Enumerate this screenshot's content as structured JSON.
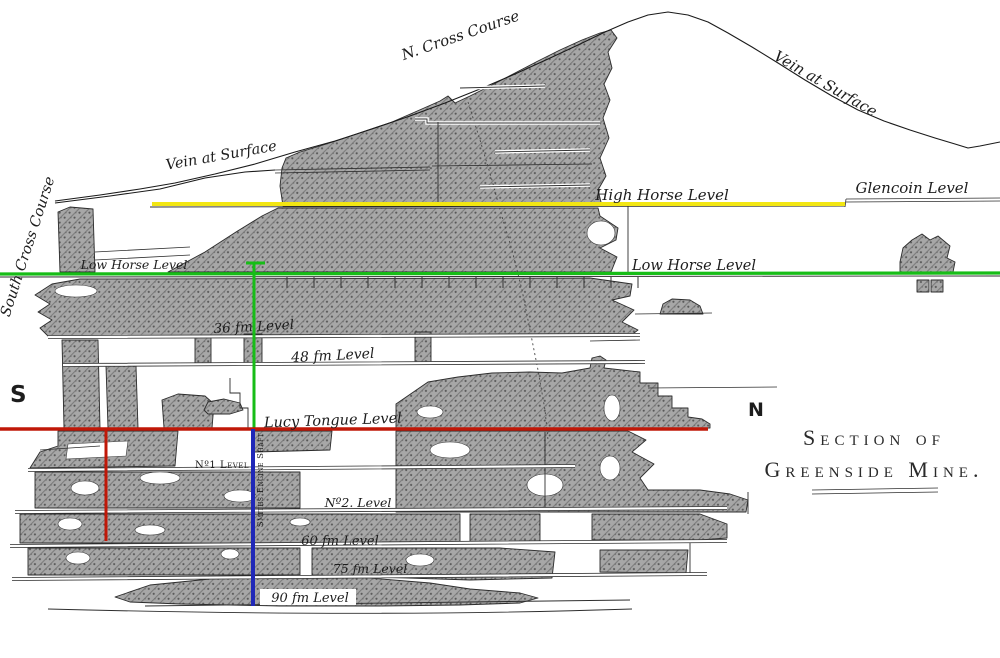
{
  "title": {
    "line1": "Section of",
    "line2": "Greenside Mine."
  },
  "compass": {
    "south": "S",
    "north": "N"
  },
  "surface_labels": {
    "south_cross_course": "South Cross Course",
    "north_cross_course": "N. Cross Course",
    "vein_at_surface_left": "Vein at Surface",
    "vein_at_surface_right": "Vein at Surface"
  },
  "levels": {
    "high_horse": "High Horse Level",
    "glencoin": "Glencoin Level",
    "low_horse_south": "Low Horse Level",
    "low_horse_north": "Low Horse Level",
    "fm36": "36 fm Level",
    "fm48": "48 fm Level",
    "lucy_tongue": "Lucy Tongue Level",
    "no1": "Nº1 Level",
    "no2": "Nº2. Level",
    "fm60": "60 fm Level",
    "fm75": "75 fm Level",
    "fm90": "90 fm Level"
  },
  "shaft": {
    "smiths_engine": "Smiths Engine Shaft"
  },
  "colors": {
    "high_horse_line": "#f2e613",
    "low_horse_line": "#17bd17",
    "lucy_tongue_line": "#c01808",
    "shaft_line": "#2028b8"
  }
}
